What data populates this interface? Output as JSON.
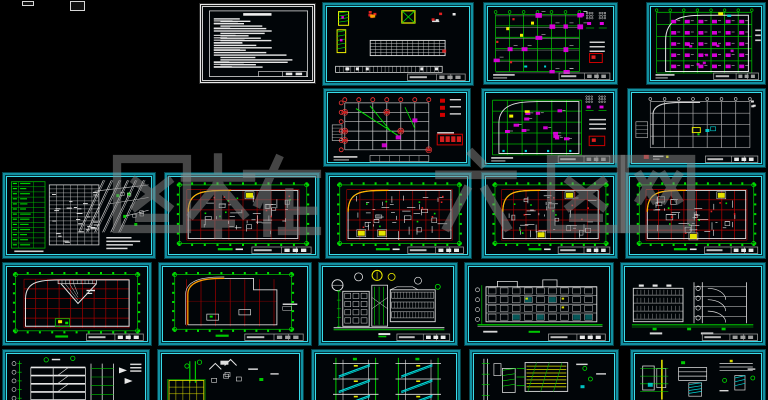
{
  "title": "architectural-cad-drawing-set-preview",
  "palette": {
    "background": "#000000",
    "sheet_border_teal": "#38dcea",
    "sheet_border_teal_dark": "#128fa0",
    "sheet_frame_white": "#e9e9e9",
    "grid_green": "#00b400",
    "green_bright": "#00e000",
    "grid_red": "#9a0000",
    "red_bright": "#e02020",
    "magenta": "#e000e0",
    "yellow": "#f0f000",
    "orange_arc": "#ffb400",
    "cyan": "#00d8d8",
    "white_line": "#e2e2e2",
    "gray_line": "#a0a0a0"
  },
  "watermark": {
    "color": "#8a8a8a",
    "opacity": 0.5,
    "glyphs": [
      {
        "char": "图",
        "x": 106,
        "y": 148,
        "size": 92
      },
      {
        "char": "本",
        "x": 172,
        "y": 150,
        "size": 92
      },
      {
        "char": "在",
        "x": 236,
        "y": 150,
        "size": 92
      },
      {
        "char": "六",
        "x": 428,
        "y": 146,
        "size": 96
      },
      {
        "char": "图",
        "x": 540,
        "y": 148,
        "size": 92
      },
      {
        "char": "网",
        "x": 612,
        "y": 148,
        "size": 92
      }
    ]
  },
  "fragments": [
    {
      "x": 22,
      "y": 1,
      "w": 10,
      "h": 3
    },
    {
      "x": 70,
      "y": 1,
      "w": 13,
      "h": 8
    }
  ],
  "sheets": [
    {
      "id": "general-notes",
      "kind": "notes",
      "frame": "white",
      "x": 199,
      "y": 3,
      "w": 117,
      "h": 81
    },
    {
      "id": "rebar-details",
      "kind": "detailTable",
      "x": 322,
      "y": 2,
      "w": 152,
      "h": 84
    },
    {
      "id": "struct-plan-1",
      "kind": "structPlan",
      "x": 483,
      "y": 2,
      "w": 135,
      "h": 83
    },
    {
      "id": "struct-plan-2",
      "kind": "structPlanFilled",
      "x": 646,
      "y": 2,
      "w": 120,
      "h": 83
    },
    {
      "id": "foundation-plan",
      "kind": "foundPlan",
      "x": 323,
      "y": 88,
      "w": 148,
      "h": 79
    },
    {
      "id": "struct-plan-3",
      "kind": "structPlan2",
      "x": 481,
      "y": 88,
      "w": 137,
      "h": 80
    },
    {
      "id": "struct-plan-4",
      "kind": "monoPlan",
      "x": 627,
      "y": 88,
      "w": 139,
      "h": 80
    },
    {
      "id": "site-plan-sheet",
      "kind": "siteSheet",
      "x": 2,
      "y": 172,
      "w": 154,
      "h": 87
    },
    {
      "id": "floor-plan-1",
      "kind": "floorplan",
      "x": 164,
      "y": 172,
      "w": 156,
      "h": 87,
      "v": 0
    },
    {
      "id": "floor-plan-2",
      "kind": "floorplan",
      "x": 325,
      "y": 172,
      "w": 147,
      "h": 87,
      "v": 1
    },
    {
      "id": "floor-plan-3",
      "kind": "floorplan",
      "x": 481,
      "y": 172,
      "w": 137,
      "h": 87,
      "v": 2
    },
    {
      "id": "floor-plan-4",
      "kind": "floorplan",
      "x": 625,
      "y": 172,
      "w": 141,
      "h": 87,
      "v": 3
    },
    {
      "id": "roof-plan-1",
      "kind": "roofPlan",
      "x": 2,
      "y": 262,
      "w": 150,
      "h": 84
    },
    {
      "id": "roof-plan-2",
      "kind": "roofPlan2",
      "x": 158,
      "y": 262,
      "w": 154,
      "h": 84
    },
    {
      "id": "elevation-1",
      "kind": "elevationA",
      "x": 318,
      "y": 262,
      "w": 140,
      "h": 84
    },
    {
      "id": "elevation-2",
      "kind": "elevationB",
      "x": 464,
      "y": 262,
      "w": 150,
      "h": 84
    },
    {
      "id": "elevation-3",
      "kind": "elevationC",
      "x": 620,
      "y": 262,
      "w": 146,
      "h": 84
    },
    {
      "id": "section-1",
      "kind": "section",
      "x": 2,
      "y": 349,
      "w": 148,
      "h": 56
    },
    {
      "id": "stair-detail",
      "kind": "stairDetail",
      "x": 157,
      "y": 349,
      "w": 147,
      "h": 56
    },
    {
      "id": "stair-section",
      "kind": "stairSection",
      "x": 311,
      "y": 349,
      "w": 150,
      "h": 56
    },
    {
      "id": "wall-detail",
      "kind": "detailYellow",
      "x": 469,
      "y": 349,
      "w": 150,
      "h": 56
    },
    {
      "id": "node-details",
      "kind": "detailMisc",
      "x": 630,
      "y": 349,
      "w": 136,
      "h": 56
    }
  ]
}
